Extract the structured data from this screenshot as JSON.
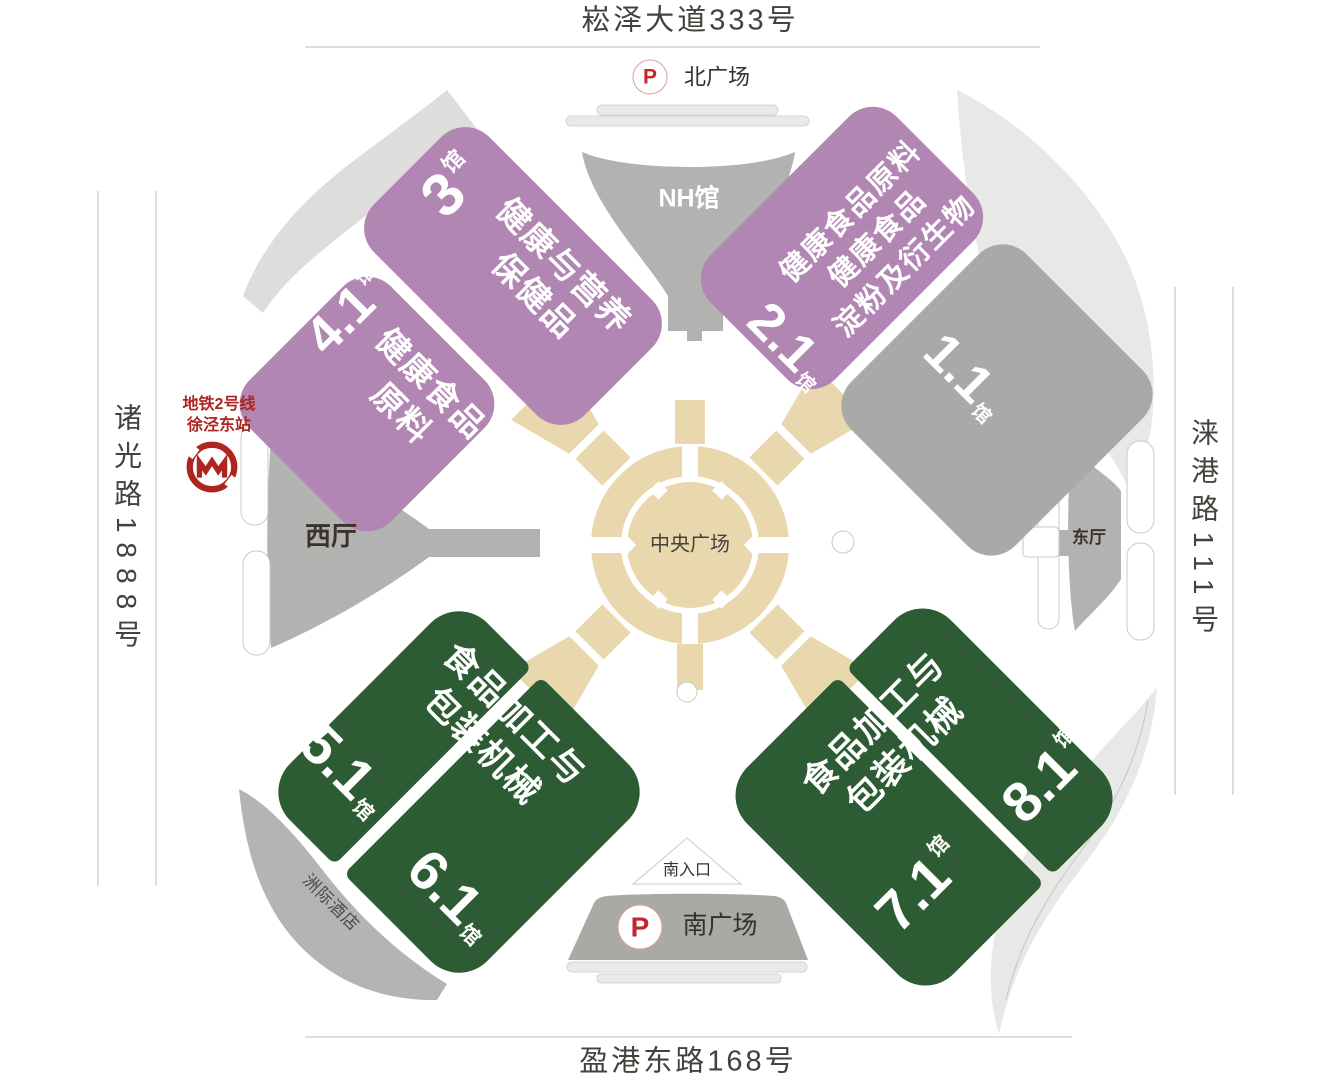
{
  "colors": {
    "purple": "#b286b2",
    "green": "#2d5c34",
    "hall_gray": "#a9a9a7",
    "structure_gray": "#b2b2b0",
    "plaza_tan": "#e9d8ae",
    "band_light": "#e8e8e6",
    "band_gray": "#b4b4b2",
    "south_band_gray": "#a9a9a6",
    "parking_red": "#c4242c",
    "metro_red": "#ae241f",
    "line_gray": "#c9c9c7",
    "label_dark": "#45413d"
  },
  "roads": {
    "top": "崧泽大道333号",
    "bottom": "盈港东路168号",
    "left": "诸光路1888号",
    "right": "涞港路111号"
  },
  "places": {
    "north_plaza": "北广场",
    "south_plaza": "南广场",
    "south_entrance": "南入口",
    "central_plaza": "中央广场",
    "west_hall": "西厅",
    "east_hall": "东厅",
    "nh_hall": "NH馆",
    "hotel": "洲际酒店",
    "parking_symbol": "P"
  },
  "metro": {
    "line": "地铁2号线",
    "station": "徐泾东站"
  },
  "halls": {
    "h3": {
      "num": "3",
      "unit": "馆",
      "category": "健康与营养\n保健品"
    },
    "h41": {
      "num": "4.1",
      "unit": "馆",
      "category": "健康食品\n原料"
    },
    "h21": {
      "num": "2.1",
      "unit": "馆",
      "category": "健康食品原料\n健康食品\n淀粉及衍生物"
    },
    "h11": {
      "num": "1.1",
      "unit": "馆"
    },
    "h51": {
      "num": "5.1",
      "unit": "馆"
    },
    "h61": {
      "num": "6.1",
      "unit": "馆"
    },
    "h71": {
      "num": "7.1",
      "unit": "馆"
    },
    "h81": {
      "num": "8.1",
      "unit": "馆"
    },
    "southwest_category": "食品加工与\n包装机械",
    "southeast_category": "食品加工与\n包装机械"
  }
}
